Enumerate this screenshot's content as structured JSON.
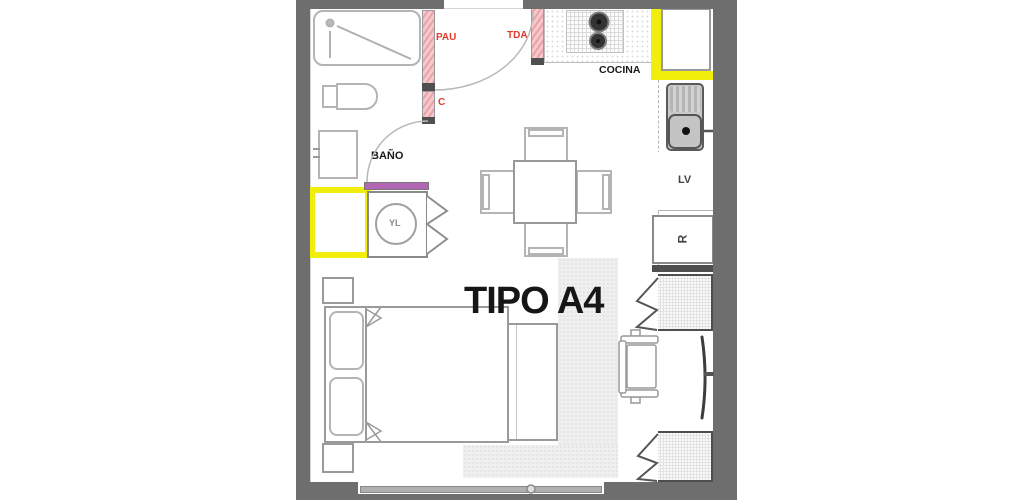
{
  "plan": {
    "title": "TIPO A4",
    "rooms": {
      "bathroom": "BAÑO",
      "kitchen": "COCINA"
    },
    "labels": {
      "pau": "PAU",
      "tda": "TDA",
      "closet_c": "C",
      "washer": "YL",
      "dishwasher": "LV",
      "fridge": "R"
    },
    "colors": {
      "wall": "#6e6e6e",
      "wall_dark": "#4f4f4f",
      "highlight_yellow": "#f2ee0c",
      "door_pink": "#f6c8cb",
      "door_pink_stripe": "#e9a2a8",
      "accent_purple": "#b266b4",
      "label_red": "#e03a2f",
      "text": "#1a1a1a",
      "line_gray": "#9e9e9e",
      "fixture_fill": "#c9c9c9"
    }
  }
}
